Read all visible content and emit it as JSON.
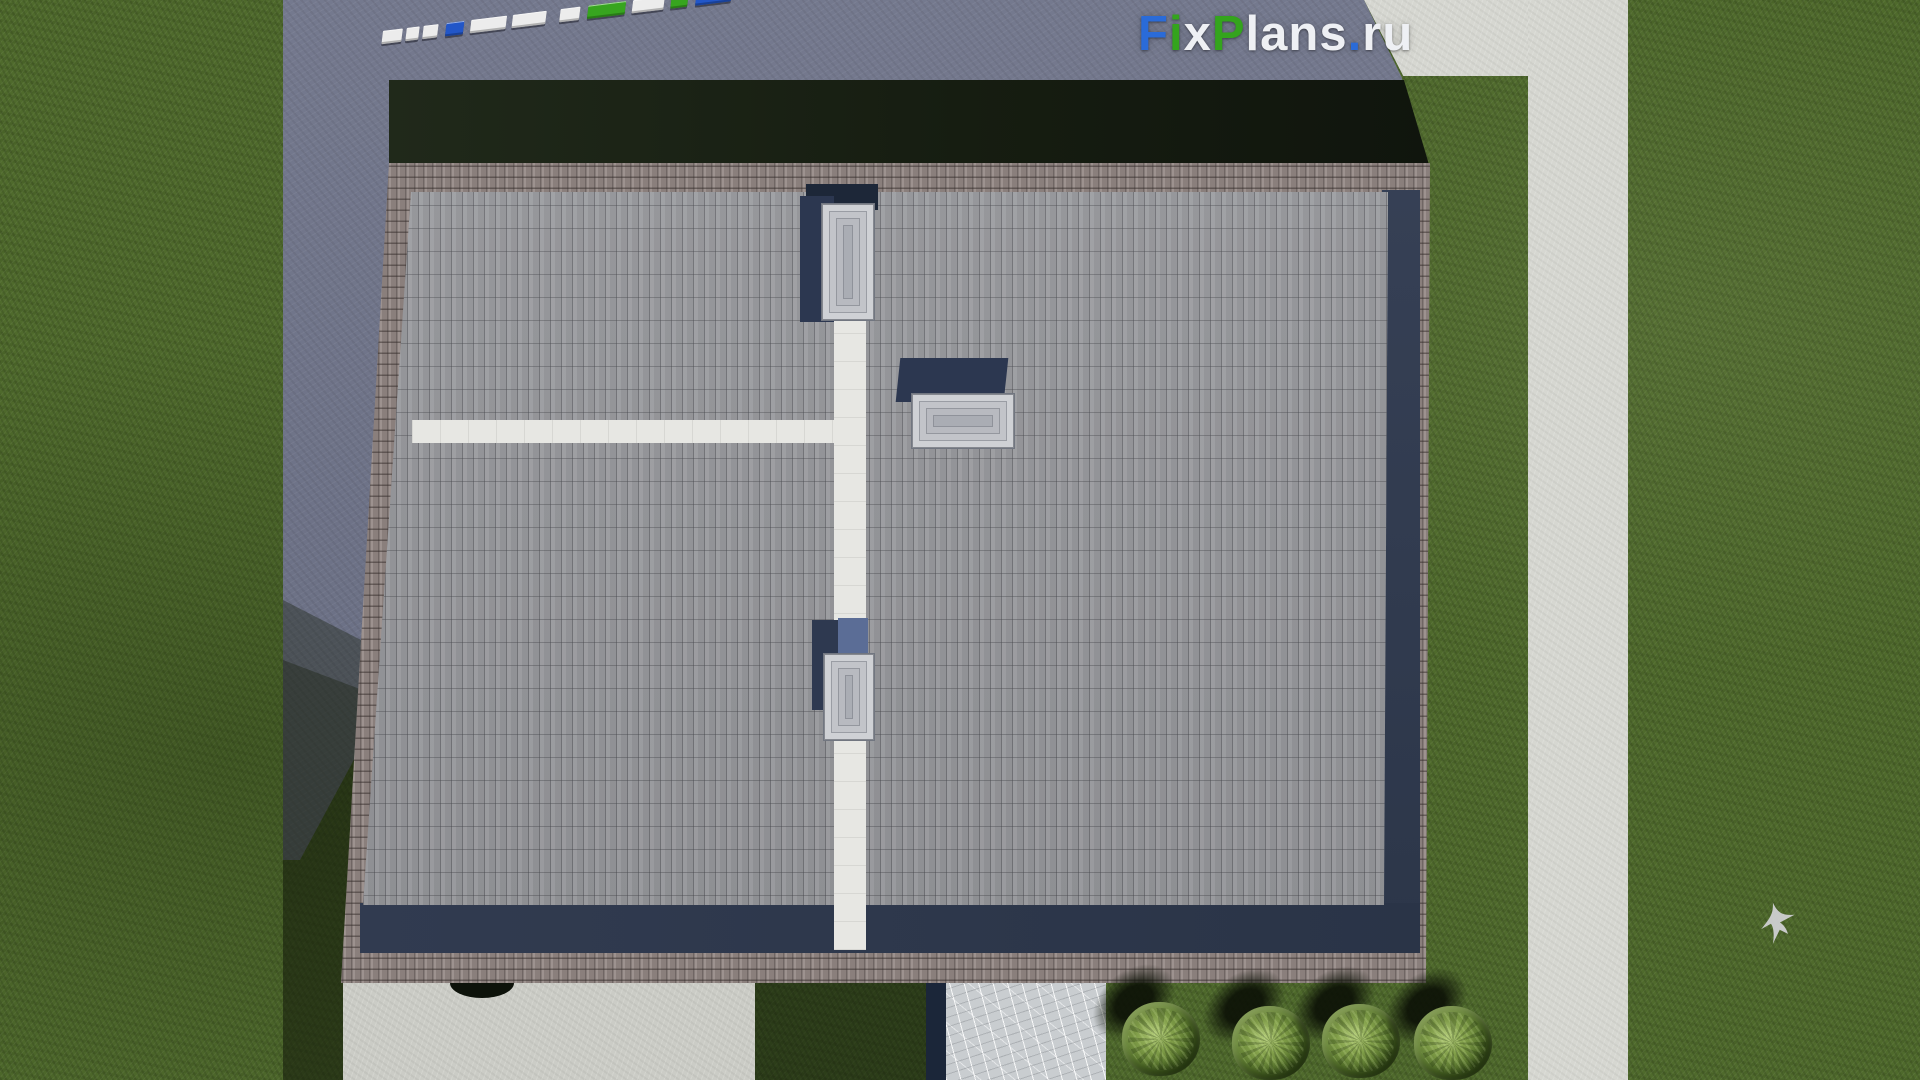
{
  "watermark": {
    "text": "FixPlans.ru",
    "letters": [
      {
        "ch": "F",
        "color": "#2a6bd8"
      },
      {
        "ch": "i",
        "color": "#34a41d"
      },
      {
        "ch": "x",
        "color": "#eef0f4"
      },
      {
        "ch": "P",
        "color": "#34a41d"
      },
      {
        "ch": "l",
        "color": "#eef0f4"
      },
      {
        "ch": "a",
        "color": "#eef0f4"
      },
      {
        "ch": "n",
        "color": "#eef0f4"
      },
      {
        "ch": "s",
        "color": "#eef0f4"
      },
      {
        "ch": ".",
        "color": "#2a6bd8"
      },
      {
        "ch": "r",
        "color": "#eef0f4"
      },
      {
        "ch": "u",
        "color": "#eef0f4"
      }
    ]
  },
  "scene": {
    "type": "aerial-3d-architectural-render",
    "view": "top-down roof / site plan",
    "palette": {
      "grass": "#4f6a2c",
      "building_shadow_on_pavement": "#6d7288",
      "grass_shadow_band": "#161d11",
      "roof_parapet_brick": "#938784",
      "roof_tiles": "#9a9b9f",
      "roof_inner_shadow_navy": "#313b50",
      "ridge_strips_white": "#e7e7e3",
      "skylight_grey": "#c7c9cd",
      "skylight_shadow_navy": "#2c3750",
      "skylight_shadow_light_blue": "#5b6d96",
      "concrete_path_white": "#d6d7d1",
      "marble_walkway": "#c9cdd0",
      "marble_edge_navy": "#1b2639",
      "bush_green": "#55732a",
      "bird_grey": "#d2d3d7"
    },
    "objects": {
      "roof_skylights_count": 3,
      "white_ridge_strips": 2,
      "bushes_count": 4,
      "birds_count": 1
    }
  },
  "scale_bar": {
    "segments": [
      {
        "color": "#ececec",
        "w": 20,
        "gap": 4
      },
      {
        "color": "#ececec",
        "w": 13,
        "gap": 4
      },
      {
        "color": "#ececec",
        "w": 15,
        "gap": 8
      },
      {
        "color": "#2256c8",
        "w": 18,
        "gap": 7
      },
      {
        "color": "#ececec",
        "w": 36,
        "gap": 6
      },
      {
        "color": "#ececec",
        "w": 34,
        "gap": 14
      },
      {
        "color": "#ececec",
        "w": 20,
        "gap": 8
      },
      {
        "color": "#37a51f",
        "w": 38,
        "gap": 7
      },
      {
        "color": "#ececec",
        "w": 32,
        "gap": 7
      },
      {
        "color": "#37a51f",
        "w": 17,
        "gap": 8
      },
      {
        "color": "#2256c8",
        "w": 36,
        "gap": 0
      }
    ]
  }
}
